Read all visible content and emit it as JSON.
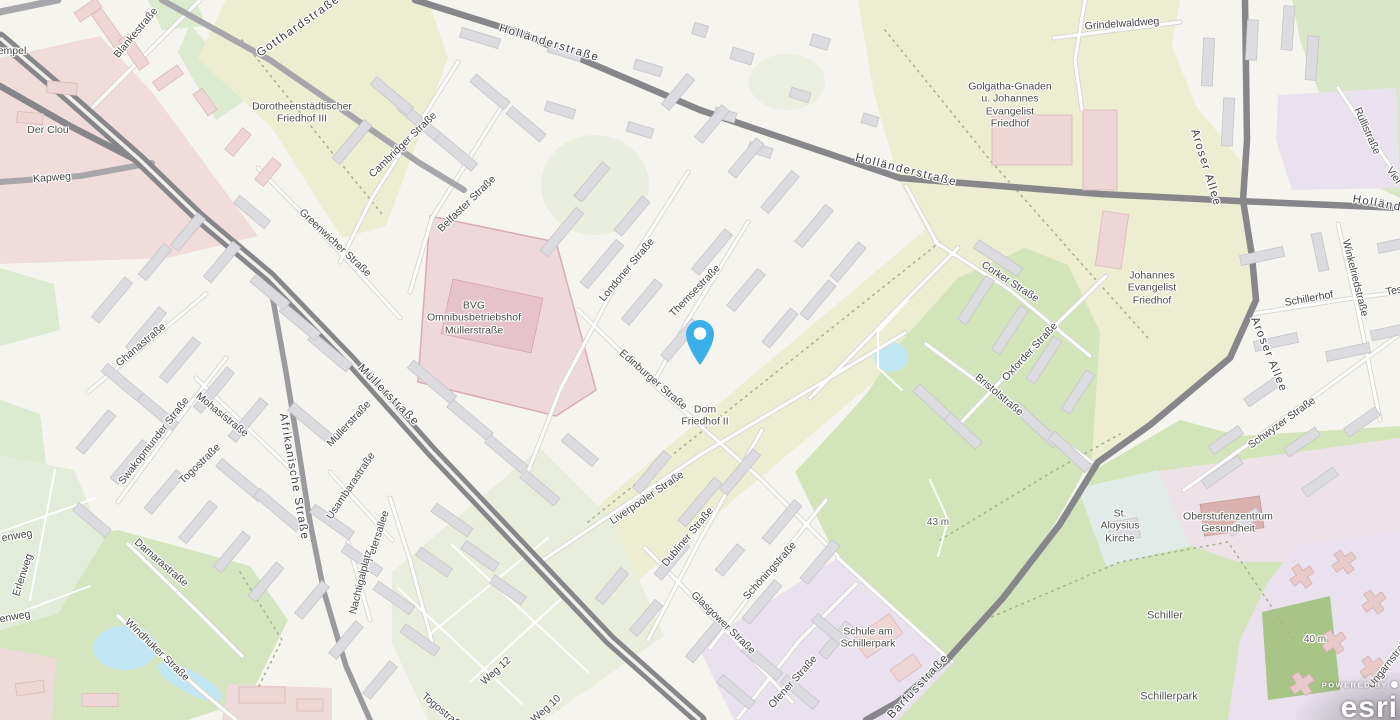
{
  "map": {
    "attribution": {
      "powered_by": "POWERED BY",
      "brand": "esri"
    },
    "marker": {
      "name": "location-pin",
      "color": "#3AAFE9",
      "x": 700,
      "y": 340
    },
    "palette": {
      "base": "#f6f4ee",
      "park": "#d3e4ba",
      "cemetery": "#ecedd1",
      "water": "#c3e6f4",
      "road_major": "#87878b",
      "road_medium": "#a7a6aa",
      "building": "#dcdbdf",
      "building_pink": "#eed6d6",
      "zone_pink": "#f1dcdc",
      "zone_purple": "#e9e2ee"
    },
    "elevations": [
      "43 m",
      "40 m"
    ],
    "labels": [
      {
        "t": "empel",
        "x": 12,
        "y": 51,
        "r": 0,
        "c": "street"
      },
      {
        "t": "Blankestraße",
        "x": 136,
        "y": 33,
        "r": -50,
        "c": "street"
      },
      {
        "t": "Gotthardstraße",
        "x": 299,
        "y": 27,
        "r": -35,
        "c": "major"
      },
      {
        "t": "Holländerstraße",
        "x": 549,
        "y": 44,
        "r": 17,
        "c": "major"
      },
      {
        "t": "Holländerstraße",
        "x": 906,
        "y": 171,
        "r": 14,
        "c": "major"
      },
      {
        "t": "Holländerstraße",
        "x": 1404,
        "y": 209,
        "r": 10,
        "c": "major"
      },
      {
        "t": "Grindelwaldweg",
        "x": 1122,
        "y": 24,
        "r": -4,
        "c": "street"
      },
      {
        "t": "Rüllistraße",
        "x": 1367,
        "y": 131,
        "r": 66,
        "c": "street"
      },
      {
        "t": "Vier",
        "x": 1394,
        "y": 176,
        "r": 55,
        "c": "street"
      },
      {
        "t": "Der Clou",
        "x": 48,
        "y": 130,
        "r": 0,
        "c": "place"
      },
      {
        "t": "Kapweg",
        "x": 52,
        "y": 178,
        "r": -4,
        "c": "street"
      },
      {
        "t": "Dorotheenstädtischer\nFriedhof III",
        "x": 302,
        "y": 113,
        "r": 0,
        "c": "place"
      },
      {
        "t": "Cambridger Straße",
        "x": 403,
        "y": 145,
        "r": -44,
        "c": "street"
      },
      {
        "t": "Greenwicher Straße",
        "x": 335,
        "y": 243,
        "r": 43,
        "c": "street"
      },
      {
        "t": "Belfaster Straße",
        "x": 467,
        "y": 204,
        "r": -44,
        "c": "street"
      },
      {
        "t": "Londoner Straße",
        "x": 627,
        "y": 270,
        "r": -50,
        "c": "street"
      },
      {
        "t": "Themsestraße",
        "x": 695,
        "y": 291,
        "r": -46,
        "c": "street"
      },
      {
        "t": "Edinburger Straße",
        "x": 653,
        "y": 380,
        "r": 41,
        "c": "street"
      },
      {
        "t": "BVG\nOmnibusbetriebshof\nMüllerstraße",
        "x": 474,
        "y": 318,
        "r": 0,
        "c": "place"
      },
      {
        "t": "Müllerstraße",
        "x": 388,
        "y": 396,
        "r": 45,
        "c": "major"
      },
      {
        "t": "Müllerstraße",
        "x": 349,
        "y": 424,
        "r": -47,
        "c": "street"
      },
      {
        "t": "Afrikanische Straße",
        "x": 293,
        "y": 477,
        "r": 80,
        "c": "major"
      },
      {
        "t": "Ghanastraße",
        "x": 141,
        "y": 345,
        "r": -40,
        "c": "street"
      },
      {
        "t": "Swakopmunder Straße",
        "x": 154,
        "y": 441,
        "r": -52,
        "c": "street"
      },
      {
        "t": "Mohasistraße",
        "x": 222,
        "y": 415,
        "r": 39,
        "c": "street"
      },
      {
        "t": "Togostraße",
        "x": 200,
        "y": 464,
        "r": -44,
        "c": "street"
      },
      {
        "t": "Usambarastraße",
        "x": 351,
        "y": 486,
        "r": -56,
        "c": "street"
      },
      {
        "t": "Petersallee",
        "x": 378,
        "y": 536,
        "r": -72,
        "c": "street"
      },
      {
        "t": "Nachtigalplatz",
        "x": 361,
        "y": 582,
        "r": -76,
        "c": "street"
      },
      {
        "t": "Damarastraße",
        "x": 161,
        "y": 563,
        "r": 41,
        "c": "street"
      },
      {
        "t": "Windhuker Straße",
        "x": 157,
        "y": 650,
        "r": 44,
        "c": "street"
      },
      {
        "t": "Erlenweg",
        "x": 23,
        "y": 575,
        "r": -72,
        "c": "street"
      },
      {
        "t": "enweg",
        "x": 17,
        "y": 536,
        "r": -10,
        "c": "street"
      },
      {
        "t": "enweg",
        "x": 15,
        "y": 617,
        "r": -10,
        "c": "street"
      },
      {
        "t": "Weg 12",
        "x": 496,
        "y": 671,
        "r": -42,
        "c": "street"
      },
      {
        "t": "Weg 10",
        "x": 546,
        "y": 709,
        "r": -42,
        "c": "street"
      },
      {
        "t": "Togostraße",
        "x": 443,
        "y": 712,
        "r": 40,
        "c": "street"
      },
      {
        "t": "Liverpooler Straße",
        "x": 647,
        "y": 498,
        "r": -34,
        "c": "street"
      },
      {
        "t": "Dubliner Straße",
        "x": 688,
        "y": 537,
        "r": -50,
        "c": "street"
      },
      {
        "t": "Glasgower Straße",
        "x": 723,
        "y": 623,
        "r": 44,
        "c": "street"
      },
      {
        "t": "Schöningstraße",
        "x": 770,
        "y": 571,
        "r": -48,
        "c": "street"
      },
      {
        "t": "Ofener Straße",
        "x": 793,
        "y": 682,
        "r": -48,
        "c": "street"
      },
      {
        "t": "Dom\nFriedhof II",
        "x": 705,
        "y": 416,
        "r": 0,
        "c": "place"
      },
      {
        "t": "Golgatha-Gnaden\nu. Johannes\nEvangelist\nFriedhof",
        "x": 1010,
        "y": 105,
        "r": 0,
        "c": "place"
      },
      {
        "t": "Johannes\nEvangelist\nFriedhof",
        "x": 1152,
        "y": 288,
        "r": 0,
        "c": "place"
      },
      {
        "t": "Corker Straße",
        "x": 1010,
        "y": 282,
        "r": 33,
        "c": "street"
      },
      {
        "t": "Oxforder Straße",
        "x": 1030,
        "y": 352,
        "r": -47,
        "c": "street"
      },
      {
        "t": "Bristolstraße",
        "x": 999,
        "y": 395,
        "r": 40,
        "c": "street"
      },
      {
        "t": "Aroser Allee",
        "x": 1205,
        "y": 168,
        "r": 73,
        "c": "major"
      },
      {
        "t": "Aroser Allee",
        "x": 1268,
        "y": 355,
        "r": 68,
        "c": "major"
      },
      {
        "t": "Schillerhof",
        "x": 1309,
        "y": 299,
        "r": -10,
        "c": "street"
      },
      {
        "t": "Tes",
        "x": 1394,
        "y": 291,
        "r": -10,
        "c": "street"
      },
      {
        "t": "Winkelriedstraße",
        "x": 1355,
        "y": 278,
        "r": 76,
        "c": "street"
      },
      {
        "t": "Schwyzer Straße",
        "x": 1282,
        "y": 423,
        "r": -36,
        "c": "street"
      },
      {
        "t": "St.\nAloysius\nKirche",
        "x": 1120,
        "y": 526,
        "r": 0,
        "c": "place"
      },
      {
        "t": "Oberstufenzentrum\nGesundheit",
        "x": 1228,
        "y": 523,
        "r": 0,
        "c": "place"
      },
      {
        "t": "Schiller",
        "x": 1165,
        "y": 616,
        "r": 0,
        "c": "park"
      },
      {
        "t": "Schillerpark",
        "x": 1169,
        "y": 697,
        "r": 0,
        "c": "park"
      },
      {
        "t": "Schule am\nSchillerpark",
        "x": 868,
        "y": 638,
        "r": 0,
        "c": "place"
      },
      {
        "t": "Barfusstraße",
        "x": 919,
        "y": 687,
        "r": -47,
        "c": "major"
      },
      {
        "t": "Ungarnstraße",
        "x": 1390,
        "y": 662,
        "r": -52,
        "c": "street"
      },
      {
        "t": "43 m",
        "x": 938,
        "y": 523,
        "r": 0,
        "c": "elev"
      },
      {
        "t": "40 m",
        "x": 1315,
        "y": 640,
        "r": 0,
        "c": "elev"
      }
    ]
  }
}
